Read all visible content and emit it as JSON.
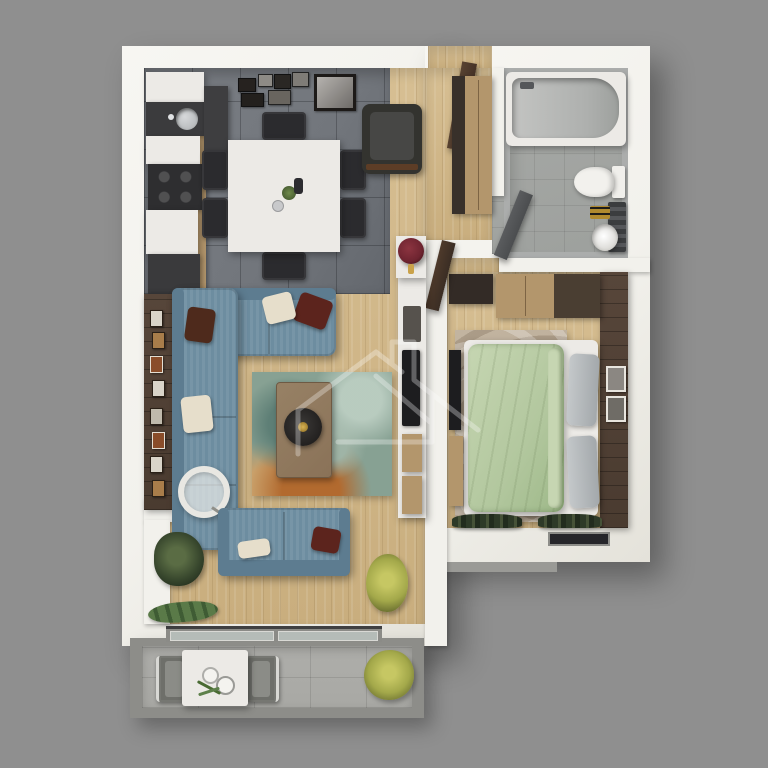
{
  "scene": {
    "description": "3D rendered top-down floor plan of a one-bedroom apartment with balcony, no text labels",
    "watermark_icon": "house-outline-watermark"
  },
  "palette": {
    "bg": "#8f8f8f",
    "wall": "#f2f1ec",
    "wood": "#d7bf93",
    "wood_dark": "#c9ae7e",
    "tile_kitchen": "#72767c",
    "tile_bath": "#9da09d",
    "bath_wall": "#abadac",
    "concrete": "#a8a8a4",
    "railing": "#8d8d89",
    "accent_wall": "#4a3b30",
    "sofa": "#6d8da0",
    "sofa_dark": "#5d7c90",
    "cushion_white": "#e6decb",
    "cushion_red": "#5c241d",
    "rug_teal": "#87a193",
    "rug_orange": "#b26a2f",
    "table_brown": "#8a7258",
    "bed_green": "#b2c79e",
    "bed_green_light": "#c6d6b2",
    "pillow_gray": "#a3a8ab",
    "rug_beige": "#b7a894",
    "tan": "#b3966c",
    "dark_furniture": "#2b2b2e",
    "black_panel": "#1d1d1f",
    "door_brown": "#453227",
    "door_gray": "#4b4d4f",
    "white_furniture": "#eceae6",
    "steel": "#b9bcbe",
    "plant_dark": "#36452c",
    "plant_yellow": "#a3a84a",
    "towel_gold": "#b08a2e",
    "lamp_red": "#6e2430",
    "glass": "#b5bcb8"
  },
  "rooms": [
    {
      "id": "kitchen-dining",
      "label": "Kitchen / Dining",
      "floor": "gray tile"
    },
    {
      "id": "living-room",
      "label": "Living Room",
      "floor": "light wood"
    },
    {
      "id": "entry-hall",
      "label": "Entry Hall",
      "floor": "light wood"
    },
    {
      "id": "bathroom",
      "label": "Bathroom",
      "floor": "stone tile"
    },
    {
      "id": "bedroom",
      "label": "Bedroom",
      "floor": "light wood"
    },
    {
      "id": "balcony",
      "label": "Balcony",
      "floor": "concrete tile"
    }
  ],
  "furniture": {
    "kitchen_dining": [
      "kitchen counter",
      "sink",
      "cooktop",
      "tall cabinet",
      "dining table",
      "6 black chairs",
      "wall picture gallery"
    ],
    "living_room": [
      "L-shaped blue sectional sofa",
      "throw pillows",
      "multicolor area rug",
      "coffee table with round tray",
      "arc floor lamp",
      "blue loveseat",
      "media console with TV",
      "red shade floor lamp",
      "accent wall with small frames",
      "potted plants"
    ],
    "entry_hall": [
      "entry door",
      "dark armchair",
      "tan wardrobe"
    ],
    "bathroom": [
      "bathtub",
      "toilet",
      "washbasin with gold towels",
      "door"
    ],
    "bedroom": [
      "double bed with sage green duvet",
      "gray pillows",
      "beige swirl rug",
      "tan wardrobe",
      "dark dresser",
      "wall TV panel",
      "dark accent wall with frames",
      "window plants"
    ],
    "balcony": [
      "white bistro table",
      "two gray chairs",
      "cups",
      "yellow shrub",
      "railing",
      "sliding glass door"
    ]
  }
}
